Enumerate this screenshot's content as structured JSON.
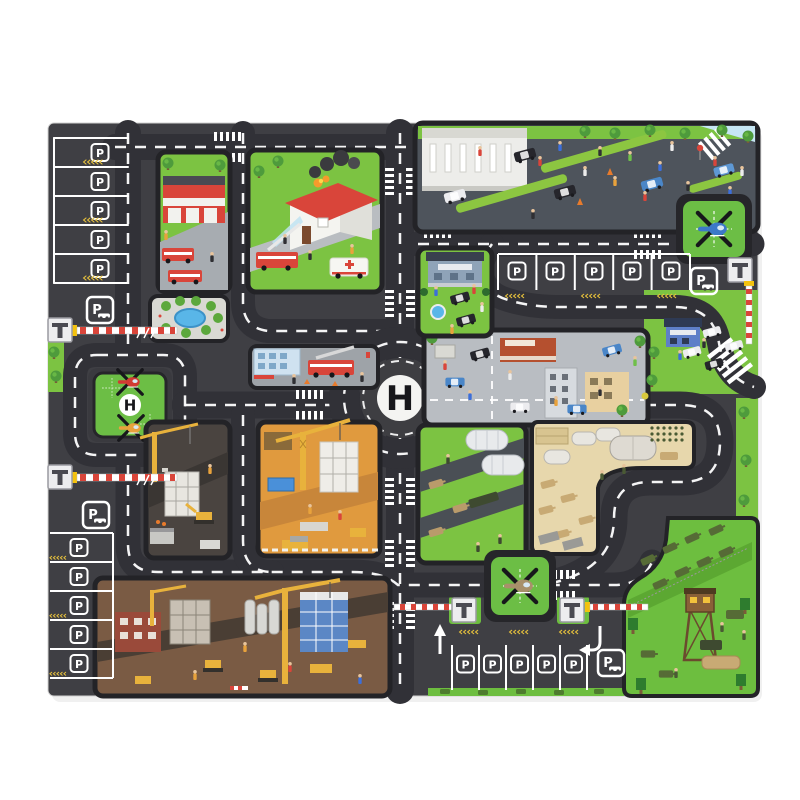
{
  "page": {
    "background": "#ffffff",
    "subject": "children's city traffic play mat, isometric printed scenes, product photo on white"
  },
  "mat": {
    "labels": {
      "helipad": "H",
      "parking": "P"
    },
    "colors": {
      "asphalt": "#3f3f44",
      "road": "#313137",
      "road_marking": "#ffffff",
      "grass": "#7cc342",
      "helipad_green": "#6cbe45",
      "panel_border": "#232327",
      "military_sand": "#e7d7ac",
      "construction_dirt": "#e09a3e",
      "excavation_brown": "#7a5b44",
      "plaza_grey": "#4e545c",
      "street_grey": "#9ea3a8",
      "water_blue": "#59b6e8",
      "sky_blue": "#c6e6f4",
      "caution_yellow": "#e8c23c",
      "barrier_red": "#d9453a"
    },
    "icons": {
      "helicopter_no_fly": "helicopter under black X rotor cross",
      "toll_booth": "white booth with dark T gantry",
      "barrier": "red-white striped boom with yellow post",
      "parking_sign": "P with car silhouette in rounded frame",
      "crosswalk": "white ladder bars",
      "chevrons": "yellow double-angle lane marks",
      "entry_arrow": "white up arrow",
      "exit_arrow": "white hooked turn arrow"
    },
    "scenes": [
      {
        "name": "fire-station",
        "theme": "red fire station with fire engines"
      },
      {
        "name": "burning-house",
        "theme": "house fire with smoke, fire engine spraying water, ambulance"
      },
      {
        "name": "police-plaza",
        "theme": "courthouse, police cars, officers and crowd"
      },
      {
        "name": "pond-park",
        "theme": "round pond ringed by bushes"
      },
      {
        "name": "ladder-truck-street",
        "theme": "fire ladder truck at blue building"
      },
      {
        "name": "police-station",
        "theme": "small station, fountain, black SUVs"
      },
      {
        "name": "city-shops",
        "theme": "shops, cars and pedestrians"
      },
      {
        "name": "police-post-east",
        "theme": "blue police post with patrol cars and zebra crossing"
      },
      {
        "name": "construction-dark",
        "theme": "building frame, crane, excavator"
      },
      {
        "name": "construction-orange",
        "theme": "tower crane over dirt site, container, machines"
      },
      {
        "name": "military-green",
        "theme": "hangars and army trucks"
      },
      {
        "name": "military-base",
        "theme": "sand camp with tents, tanks, troop formation"
      },
      {
        "name": "excavation-site",
        "theme": "large dig with cranes, silos, machines"
      },
      {
        "name": "army-camp",
        "theme": "watchtower, tank parade, trees"
      }
    ],
    "helipads": [
      {
        "location": "center-roundabout",
        "marking": "H"
      },
      {
        "location": "west-loop",
        "marking": "H",
        "aircraft": [
          "red helicopter",
          "orange helicopter"
        ]
      },
      {
        "location": "north-east",
        "aircraft": [
          "blue helicopter"
        ]
      },
      {
        "location": "south-center",
        "aircraft": [
          "army helicopter"
        ]
      }
    ],
    "parking": [
      {
        "location": "north-west",
        "spots": 5,
        "sign": true
      },
      {
        "location": "north-east",
        "spots": 5,
        "sign": true
      },
      {
        "location": "south-west",
        "spots": 5,
        "sign": true
      },
      {
        "location": "south-center",
        "spots": 5,
        "sign": true
      }
    ],
    "toll_gates": [
      "west-upper",
      "west-lower",
      "south-left",
      "south-right",
      "east-edge"
    ]
  }
}
